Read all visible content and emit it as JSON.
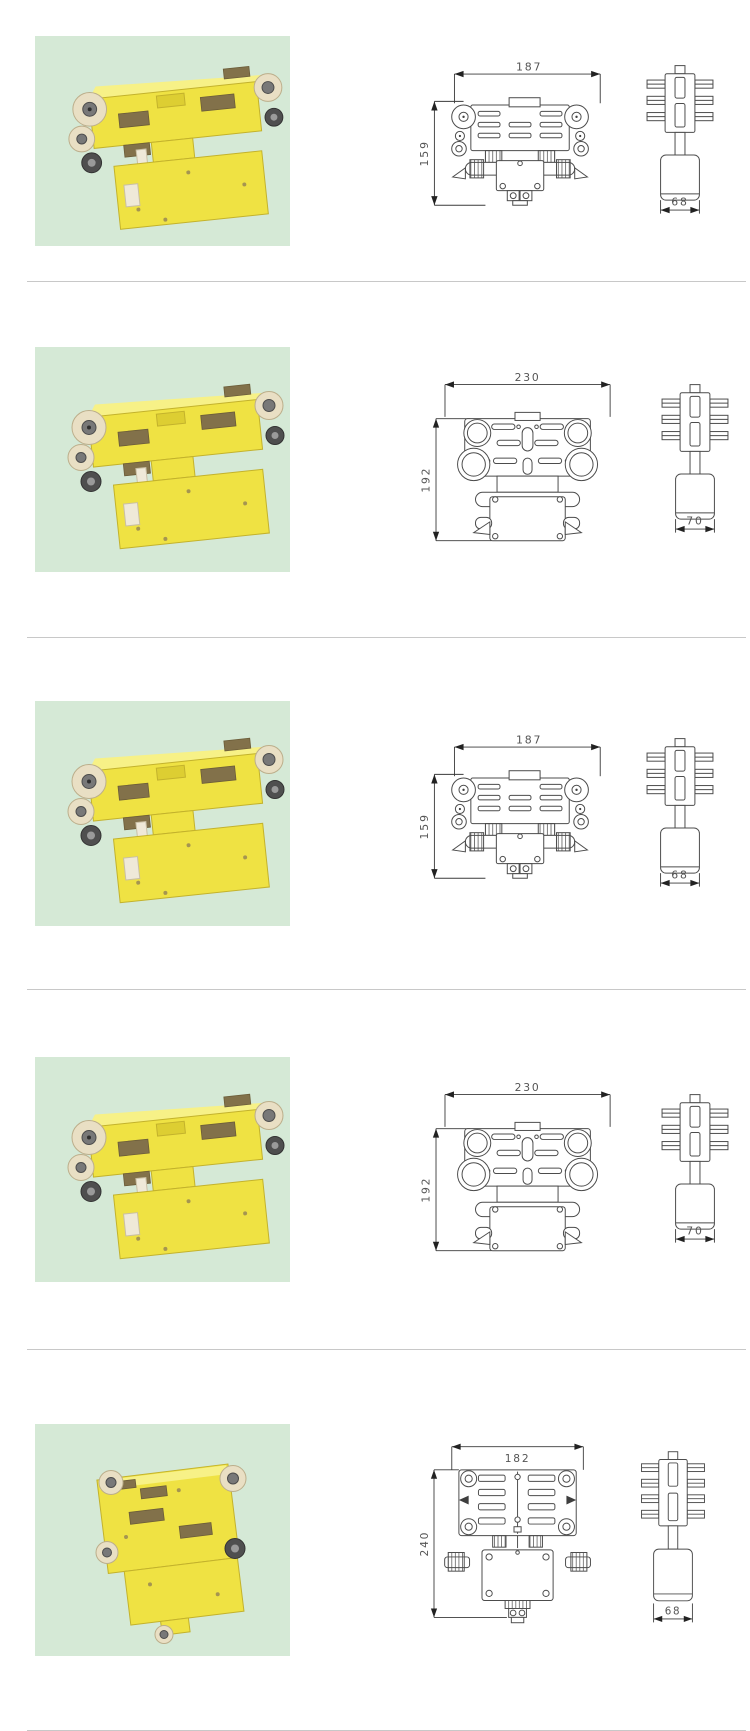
{
  "page": {
    "description": "catalog page of crane conductor-rail collector trolleys: product photo left, dimensioned front and side technical drawings right",
    "colors": {
      "photo_background": "#d5e9d6",
      "product_color": "#efe243",
      "drawing_line": "#4c4c4c",
      "divider": "#c8c8c8"
    }
  },
  "rows": [
    {
      "photo": "yellow-collector-trolley-angled-view",
      "front_width": "187",
      "front_height": "159",
      "side_width": "68"
    },
    {
      "photo": "yellow-collector-trolley-angled-view",
      "front_width": "230",
      "front_height": "192",
      "side_width": "70"
    },
    {
      "photo": "yellow-collector-trolley-angled-view",
      "front_width": "187",
      "front_height": "159",
      "side_width": "68"
    },
    {
      "photo": "yellow-collector-trolley-angled-view",
      "front_width": "230",
      "front_height": "192",
      "side_width": "70"
    },
    {
      "photo": "yellow-collector-trolley-front-view",
      "front_width": "182",
      "front_height": "240",
      "side_width": "68"
    }
  ]
}
